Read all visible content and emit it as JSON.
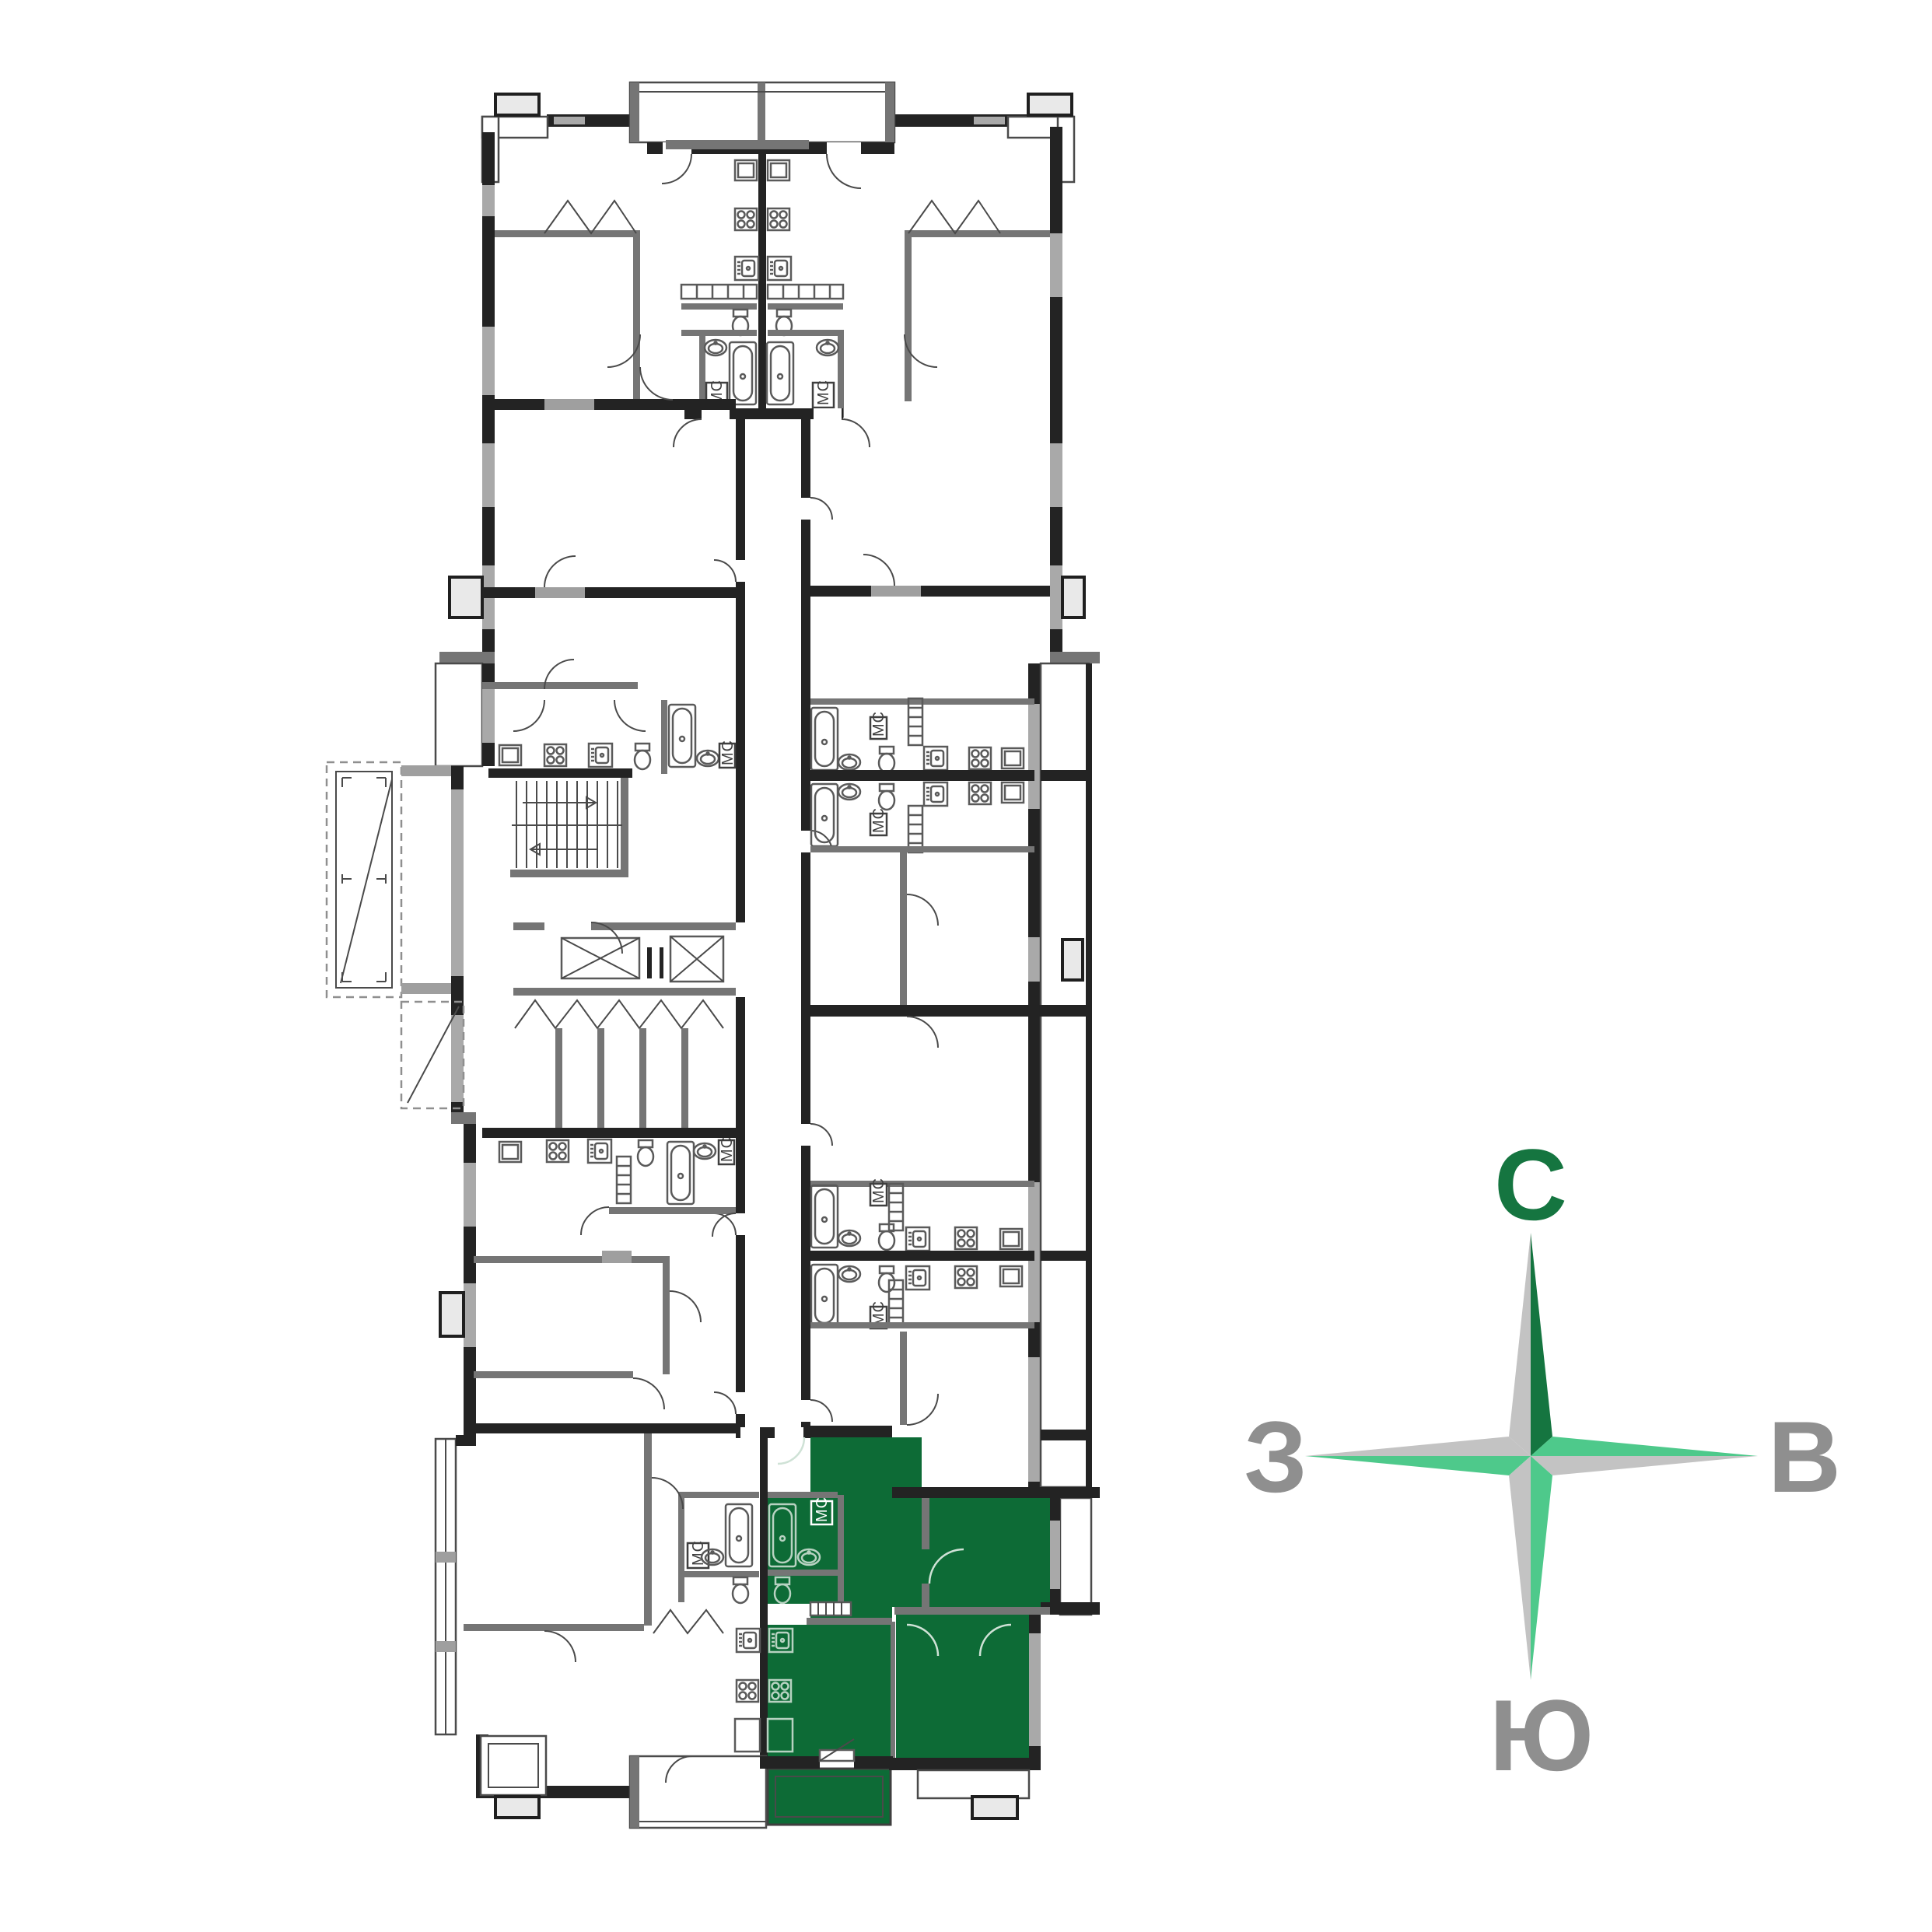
{
  "page": {
    "background": "#ffffff"
  },
  "floor_plan": {
    "mc_labels": [
      "МС",
      "МС",
      "МС",
      "МС",
      "МС",
      "МС",
      "МС",
      "МС",
      "МС",
      "МС"
    ],
    "highlighted_apartment": "green-apartment"
  },
  "compass": {
    "north": "С",
    "east": "В",
    "south": "Ю",
    "west": "З"
  },
  "colors": {
    "highlight-green": "#0d6b36",
    "compass-dark-green": "#157540",
    "compass-light-green": "#4ec98b",
    "compass-arm-gray": "#c3c3c3",
    "compass-letter-gray": "#8f8f8f",
    "wall-dark": "#232323",
    "wall-gray": "#757575",
    "window-gray": "#a9a9a9",
    "light-block": "#9f9f9f",
    "cap-fill": "#e9e9e9",
    "fixture-stroke": "#5a5a5a",
    "fixture-stroke-green": "#b7d2c1"
  }
}
